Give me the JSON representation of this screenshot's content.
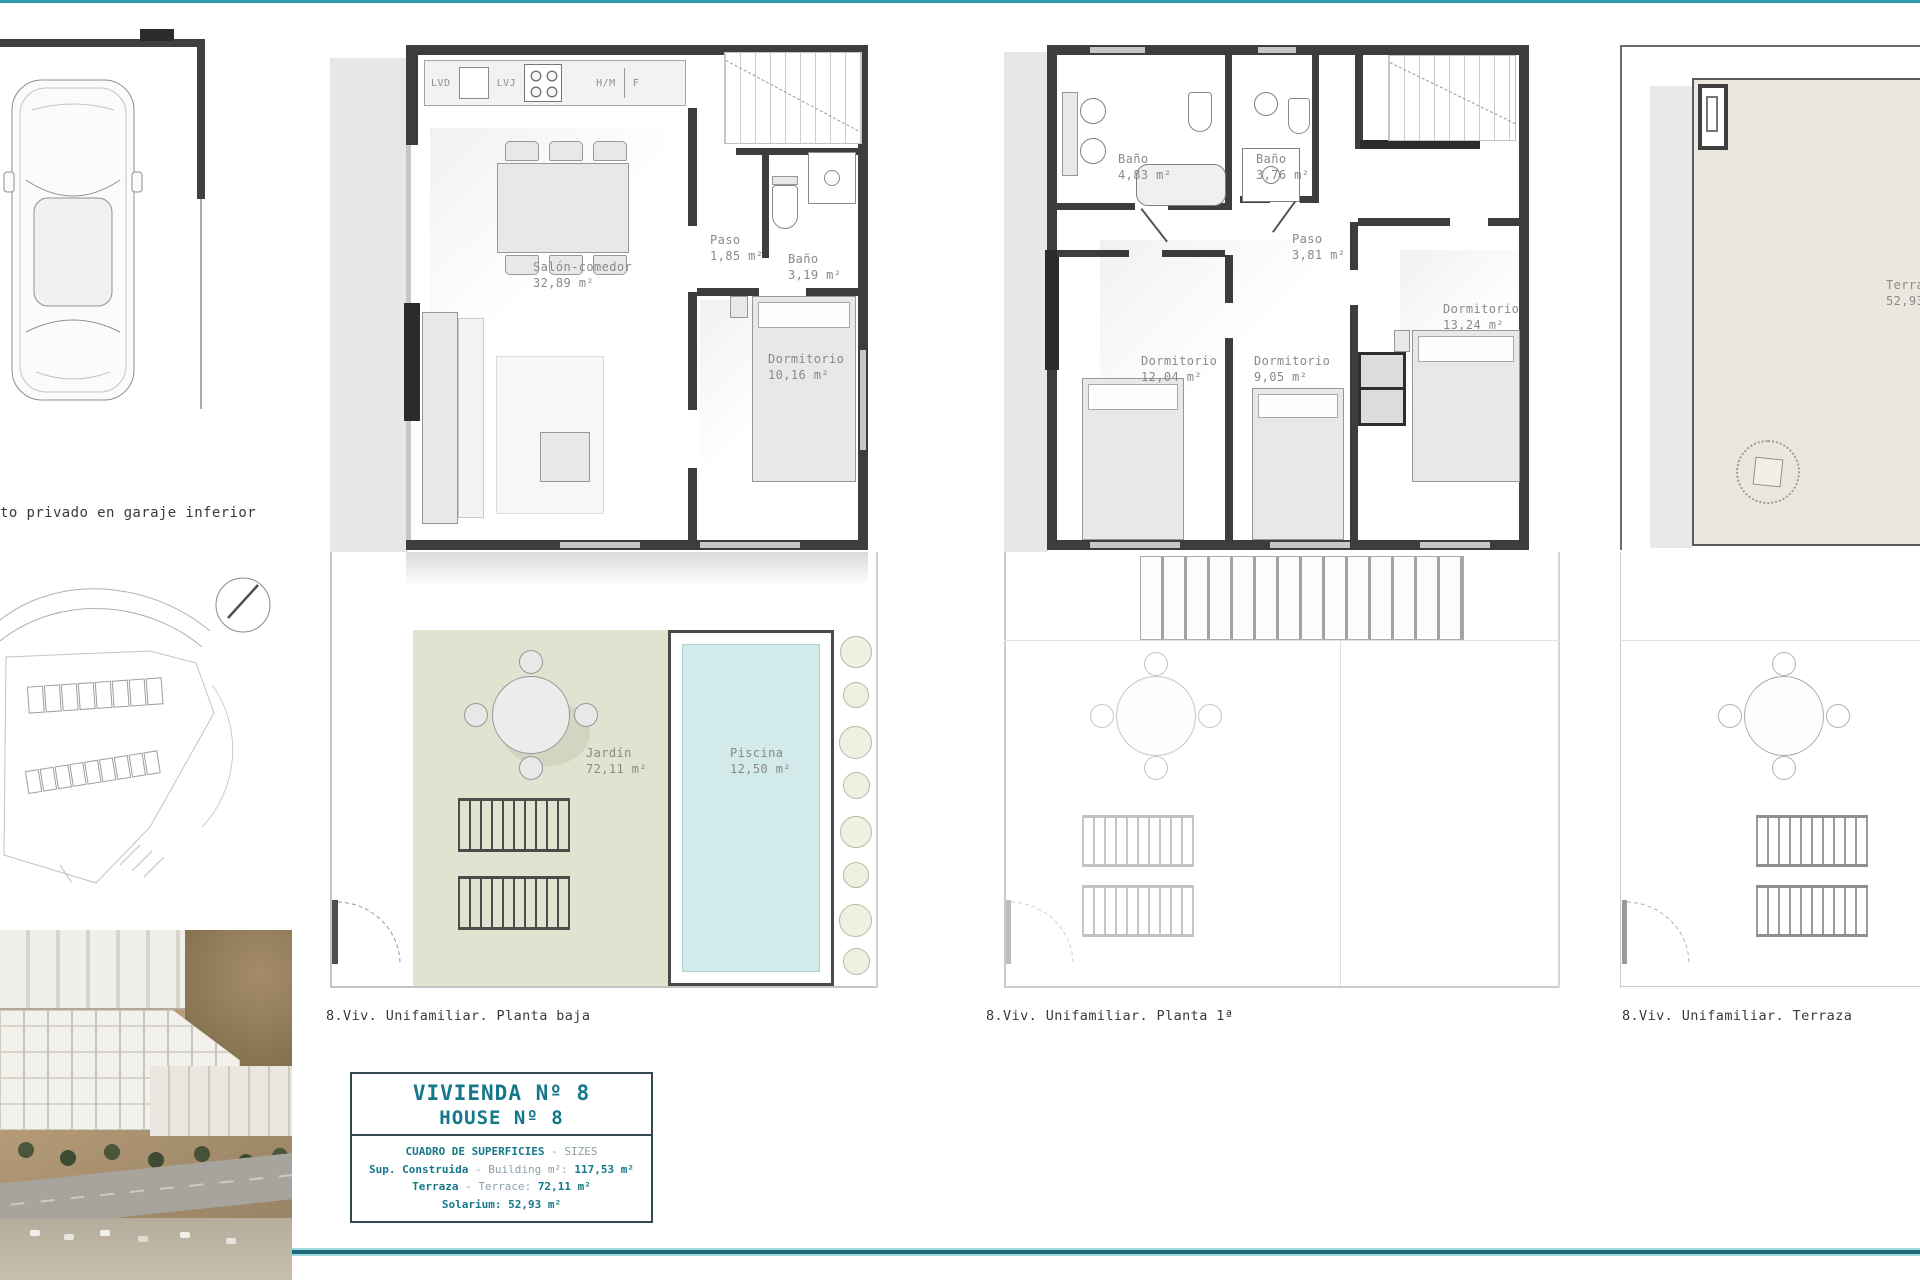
{
  "page": {
    "accent_teal": "#15788a",
    "rule_top_color": "#2d9dad",
    "rule_bottom_color": "#1d6b77",
    "garden_color": "#e0e3d0",
    "pool_color": "#d3eaeb"
  },
  "left_column": {
    "garage_caption": "to privado en garaje inferior"
  },
  "plans": [
    {
      "caption": "8.Viv. Unifamiliar. Planta baja",
      "kitchen_labels": [
        "LVD",
        "LVJ",
        "H/M",
        "F"
      ],
      "rooms": [
        {
          "name": "Salón-comedor",
          "area": "32,89 m²"
        },
        {
          "name": "Paso",
          "area": "1,85 m²"
        },
        {
          "name": "Baño",
          "area": "3,19 m²"
        },
        {
          "name": "Dormitorio",
          "area": "10,16 m²"
        },
        {
          "name": "Jardín",
          "area": "72,11 m²"
        },
        {
          "name": "Piscina",
          "area": "12,50 m²"
        }
      ]
    },
    {
      "caption": "8.Viv. Unifamiliar. Planta 1ª",
      "rooms": [
        {
          "name": "Baño",
          "area": "4,83 m²"
        },
        {
          "name": "Baño",
          "area": "3,76 m²"
        },
        {
          "name": "Paso",
          "area": "3,81 m²"
        },
        {
          "name": "Dormitorio",
          "area": "12,04 m²"
        },
        {
          "name": "Dormitorio",
          "area": "9,05 m²"
        },
        {
          "name": "Dormitorio",
          "area": "13,24 m²"
        }
      ]
    },
    {
      "caption": "8.Viv. Unifamiliar. Terraza",
      "rooms": [
        {
          "name": "Terraza",
          "area": "52,93 m²"
        }
      ]
    }
  ],
  "info_box": {
    "title_es": "VIVIENDA Nº 8",
    "title_en": "HOUSE Nº 8",
    "header_es": "CUADRO DE SUPERFICIES",
    "header_dash": "-",
    "header_en": "SIZES",
    "rows": [
      {
        "label": "Sup. Construida",
        "dash": "-",
        "sub": "Building m²:",
        "value": "117,53 m²"
      },
      {
        "label": "Terraza",
        "dash": "-",
        "sub": "Terrace:",
        "value": "72,11 m²"
      },
      {
        "label": "Solarium:",
        "dash": "",
        "sub": "",
        "value": "52,93 m²"
      }
    ]
  }
}
